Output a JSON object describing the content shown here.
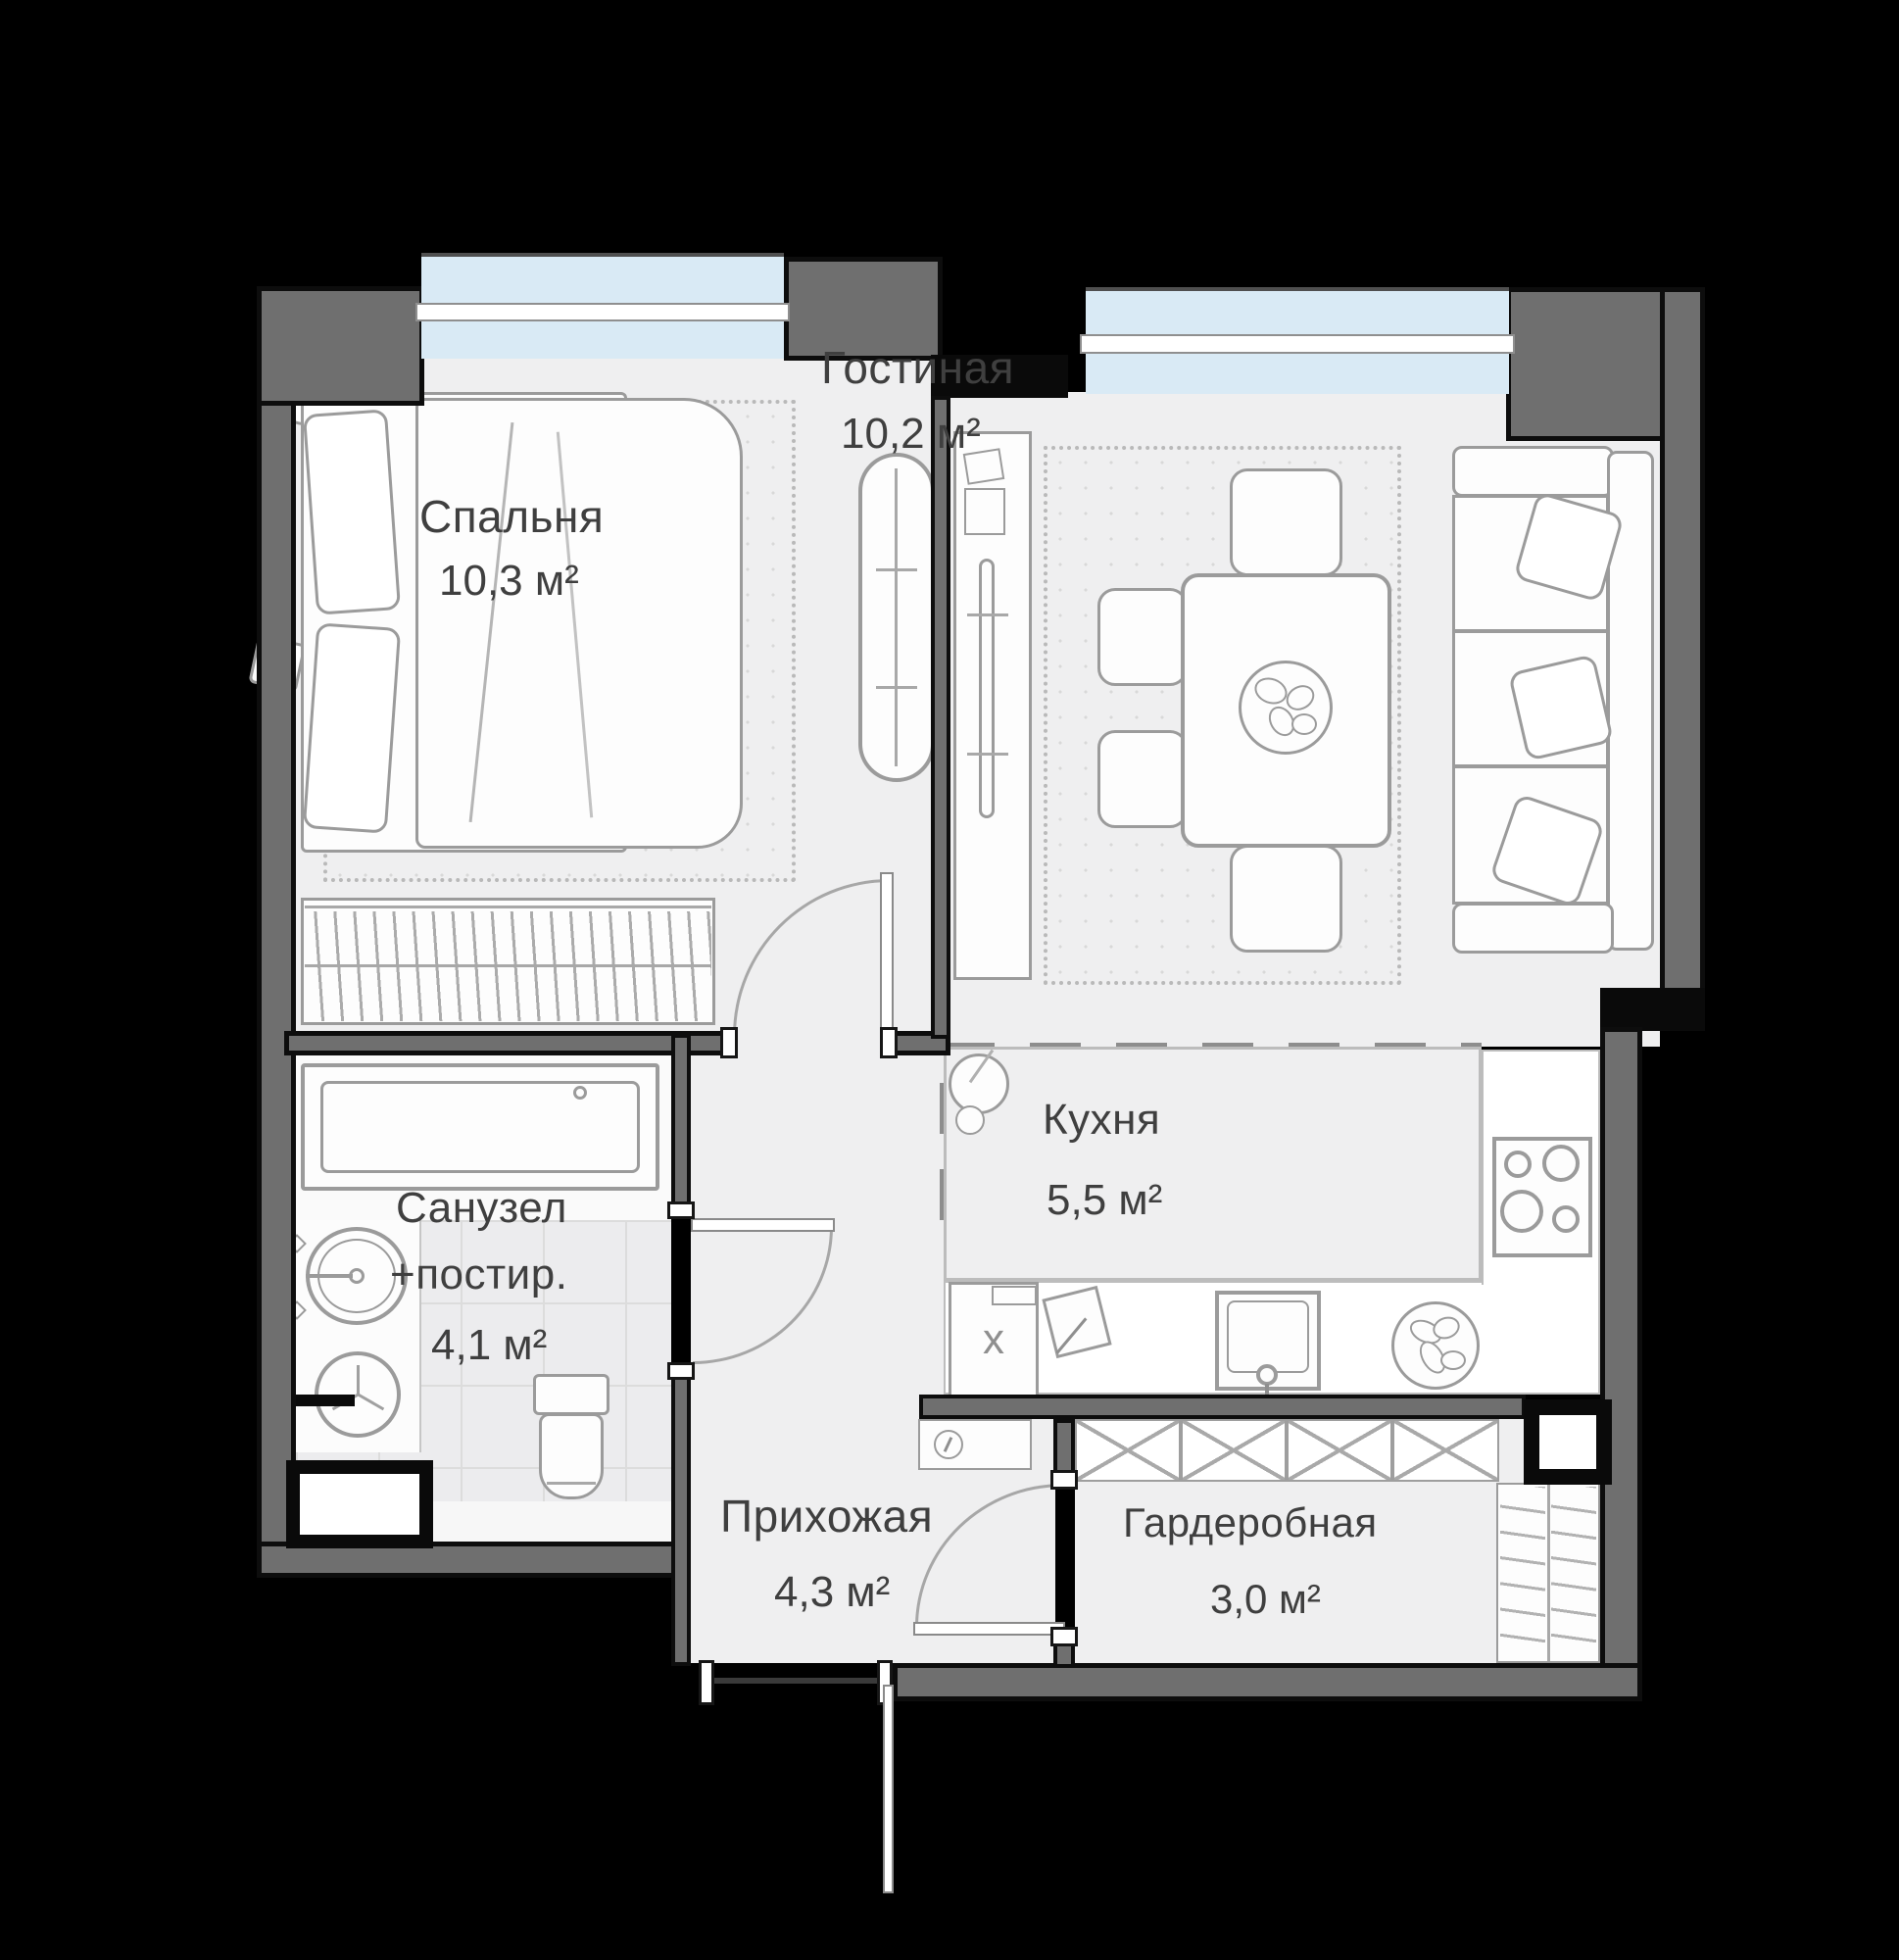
{
  "plan_type": "apartment-floor-plan",
  "language": "ru",
  "rooms": {
    "bedroom": {
      "name": "Спальня",
      "area": "10,3 м²"
    },
    "living": {
      "name": "Гостиная",
      "area": "10,2 м²"
    },
    "kitchen": {
      "name": "Кухня",
      "area": "5,5 м²"
    },
    "bathroom": {
      "name": "Санузел",
      "name2": "+постир.",
      "area": "4,1 м²"
    },
    "hallway": {
      "name": "Прихожая",
      "area": "4,3 м²"
    },
    "wardrobe": {
      "name": "Гардеробная",
      "area": "3,0 м²"
    }
  },
  "kitchen_items": {
    "x_cabinet_label": "х"
  },
  "colors": {
    "background": "#000000",
    "wall": "#6f6f6f",
    "wall_outline": "#0d0d0d",
    "floor": "#efeff0",
    "window_glass": "#d9eaf5",
    "furniture_stroke": "#9b9b9b",
    "tile": "#ececee",
    "text": "#3f3f3f"
  },
  "icons": {
    "bed": "double-bed-with-pillows",
    "ironing_board": "ironing-board",
    "closet_rod": "rod-with-hangers",
    "bathtub": "rectangular-tub",
    "wash_sink": "oval-basin",
    "washing_machine": "drum-three-spokes",
    "toilet": "tank-and-bowl",
    "tv_stand": "tv-console",
    "plant": "potted-plant",
    "dining_table": "table-four-chairs",
    "plate": "plate-of-food",
    "sofa": "three-seat-sofa",
    "kitchen_sink": "square-basin-faucet",
    "cooktop": "four-burner-hob",
    "fruit_bowl": "bowl-of-vegetables",
    "cutting_board": "board-with-knife",
    "key": "key-in-circle",
    "x_closet": "crossed-wardrobe-boxes",
    "shelf_unit": "shelving"
  }
}
